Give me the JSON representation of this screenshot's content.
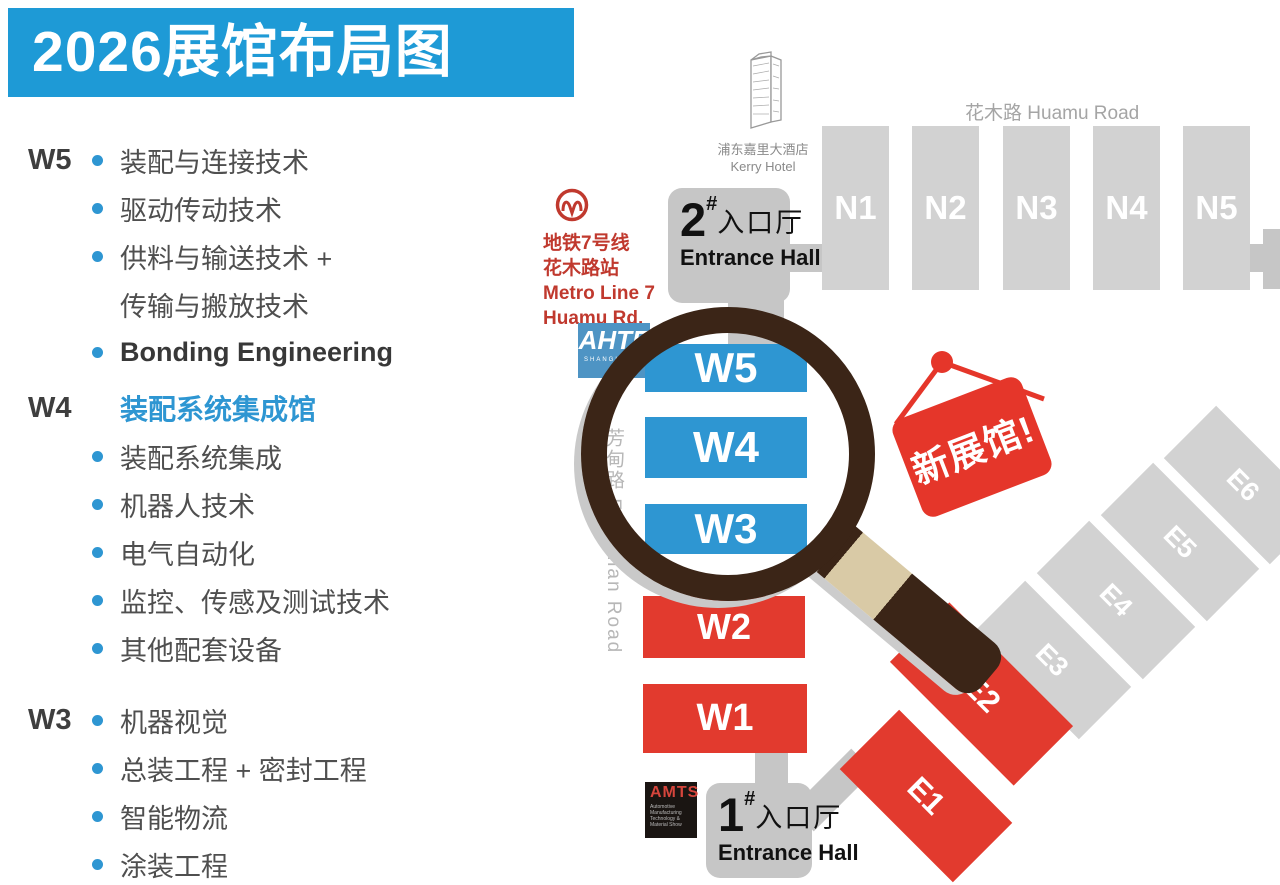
{
  "title": {
    "text": "2026展馆布局图"
  },
  "legend": {
    "sections": [
      {
        "label": "W5",
        "header": null,
        "items": [
          {
            "text": "装配与连接技术"
          },
          {
            "text": "驱动传动技术"
          },
          {
            "text": "供料与输送技术 +"
          },
          {
            "text": "传输与搬放技术"
          },
          {
            "text": "Bonding Engineering"
          }
        ]
      },
      {
        "label": "W4",
        "header": "装配系统集成馆",
        "items": [
          {
            "text": "装配系统集成"
          },
          {
            "text": "机器人技术"
          },
          {
            "text": "电气自动化"
          },
          {
            "text": "监控、传感及测试技术"
          },
          {
            "text": "其他配套设备"
          }
        ]
      },
      {
        "label": "W3",
        "header": null,
        "items": [
          {
            "text": "机器视觉"
          },
          {
            "text": "总装工程 + 密封工程"
          },
          {
            "text": "智能物流"
          },
          {
            "text": "涂装工程"
          }
        ]
      }
    ]
  },
  "map": {
    "roads": {
      "huamu": "花木路  Huamu Road",
      "fangdian": "芳甸路 Fangdian Road"
    },
    "hotel": {
      "name_cn": "浦东嘉里大酒店",
      "name_en": "Kerry Hotel"
    },
    "metro": {
      "line1": "地铁7号线",
      "line2": "花木路站",
      "line3": "Metro Line 7",
      "line4": "Huamu Rd."
    },
    "entrance2": {
      "num": "2",
      "hash": "#",
      "cn": "入口厅",
      "en": "Entrance Hall"
    },
    "entrance1": {
      "num": "1",
      "hash": "#",
      "cn": "入口厅",
      "en": "Entrance Hall"
    },
    "halls": {
      "north": [
        "N1",
        "N2",
        "N3",
        "N4",
        "N5"
      ],
      "west_blue": [
        "W5",
        "W4",
        "W3"
      ],
      "west_red": [
        "W2",
        "W1"
      ],
      "east_red": [
        "E1",
        "E2"
      ],
      "east_gray": [
        "E3",
        "E4",
        "E5",
        "E6"
      ]
    },
    "badge": {
      "text": "新展馆!"
    },
    "logos": {
      "ahte": {
        "name": "AHTE",
        "sub": "SHANGHAI"
      },
      "amts": {
        "name": "AMTS",
        "sub_lines": [
          "Automotive",
          "Manufacturing",
          "Technology &",
          "Material Show"
        ]
      }
    }
  },
  "colors": {
    "banner_blue": "#1E9AD6",
    "hall_blue": "#2E96D2",
    "hall_red": "#E23A2E",
    "badge_red": "#E5362A",
    "hall_gray": "#D2D2D2",
    "entrance_gray": "#C6C6C6",
    "metro_red": "#C0392E",
    "ring_brown": "#3B2517",
    "handle_tan": "#D9CAA6",
    "text_dark": "#3E3E3E",
    "text_gray": "#4F4F4F",
    "road_gray": "#A5A5A5"
  }
}
